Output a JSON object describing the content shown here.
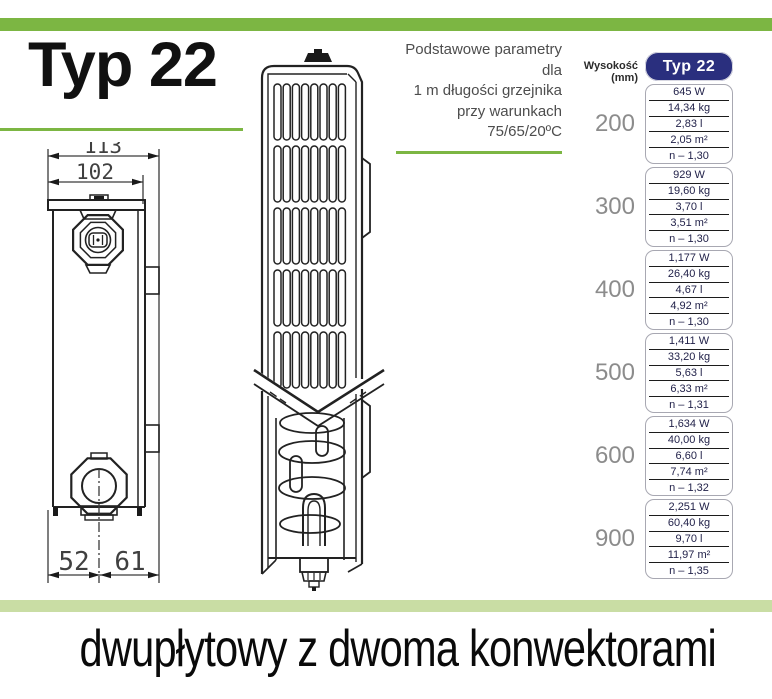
{
  "header": {
    "title": "Typ 22"
  },
  "intro": {
    "line1": "Podstawowe parametry dla",
    "line2": "1 m długości grzejnika",
    "line3": "przy warunkach",
    "line4": "75/65/20ºC"
  },
  "drawing": {
    "dim_top_outer": "113",
    "dim_top_inner": "102",
    "dim_bottom_left": "52",
    "dim_bottom_right": "61"
  },
  "table": {
    "height_label": "Wysokość (mm)",
    "column_header": "Typ 22",
    "groups": [
      {
        "height": "200",
        "values": [
          "645 W",
          "14,34 kg",
          "2,83 l",
          "2,05 m²",
          "n – 1,30"
        ]
      },
      {
        "height": "300",
        "values": [
          "929 W",
          "19,60 kg",
          "3,70 l",
          "3,51 m²",
          "n – 1,30"
        ]
      },
      {
        "height": "400",
        "values": [
          "1,177 W",
          "26,40 kg",
          "4,67 l",
          "4,92 m²",
          "n – 1,30"
        ]
      },
      {
        "height": "500",
        "values": [
          "1,411 W",
          "33,20 kg",
          "5,63 l",
          "6,33 m²",
          "n – 1,31"
        ]
      },
      {
        "height": "600",
        "values": [
          "1,634 W",
          "40,00 kg",
          "6,60 l",
          "7,74 m²",
          "n – 1,32"
        ]
      },
      {
        "height": "900",
        "values": [
          "2,251 W",
          "60,40 kg",
          "9,70 l",
          "11,97 m²",
          "n – 1,35"
        ]
      }
    ]
  },
  "footer": {
    "caption": "dwupłytowy z dwoma konwektorami"
  },
  "colors": {
    "accent_green": "#7cb643",
    "pale_green": "#c9dda4",
    "navy": "#2a2f7e"
  }
}
